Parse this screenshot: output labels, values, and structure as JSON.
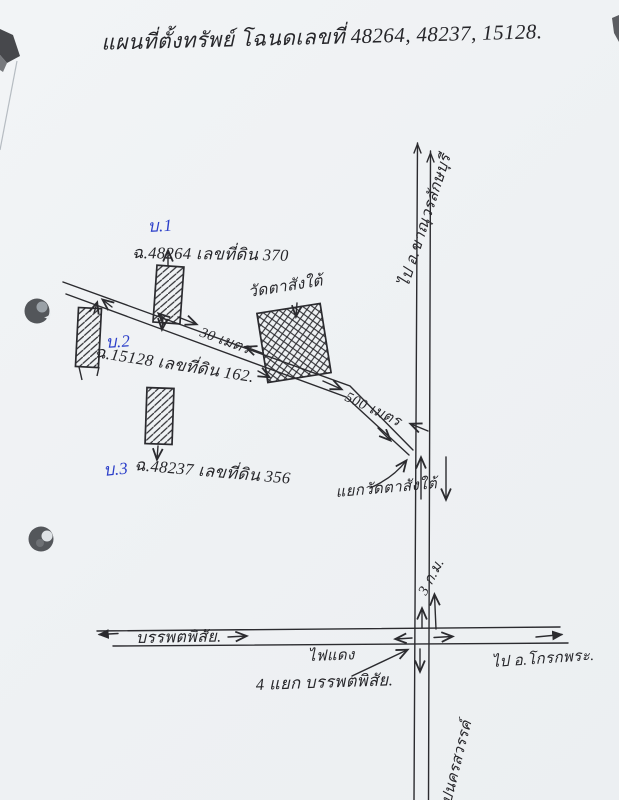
{
  "page": {
    "title": "แผนที่ตั้งทรัพย์ โฉนดเลขที่ 48264, 48237, 15128.",
    "ink_color": "#2b2b2f",
    "blue_ink_color": "#2b3ec9",
    "paper_color": "#f2f4f6"
  },
  "plots": [
    {
      "id": "บ.1",
      "deed": "ฉ.48264 เลขที่ดิน 370"
    },
    {
      "id": "บ.2",
      "deed": "ฉ.15128 เลขที่ดิน 162."
    },
    {
      "id": "บ.3",
      "deed": "ฉ.48237 เลขที่ดิน 356"
    }
  ],
  "landmarks": {
    "temple": "วัดตาสังใต้",
    "junction_top": "แยกวัดตาสังใต้",
    "junction_bottom": "4 แยก บรรพตพิสัย.",
    "traffic_light": "ไฟแดง"
  },
  "roads": {
    "north_label": "ไป อ.ขาณุวรลักษบุรี",
    "west_road_label": "บรรพตพิสัย.",
    "east_label": "ไป อ.โกรกพระ.",
    "south_label": "ไปนครสวรรค์"
  },
  "distances": {
    "d30": "30 เมตร",
    "d500": "500 เมตร",
    "km3": "3 ก.ม."
  }
}
